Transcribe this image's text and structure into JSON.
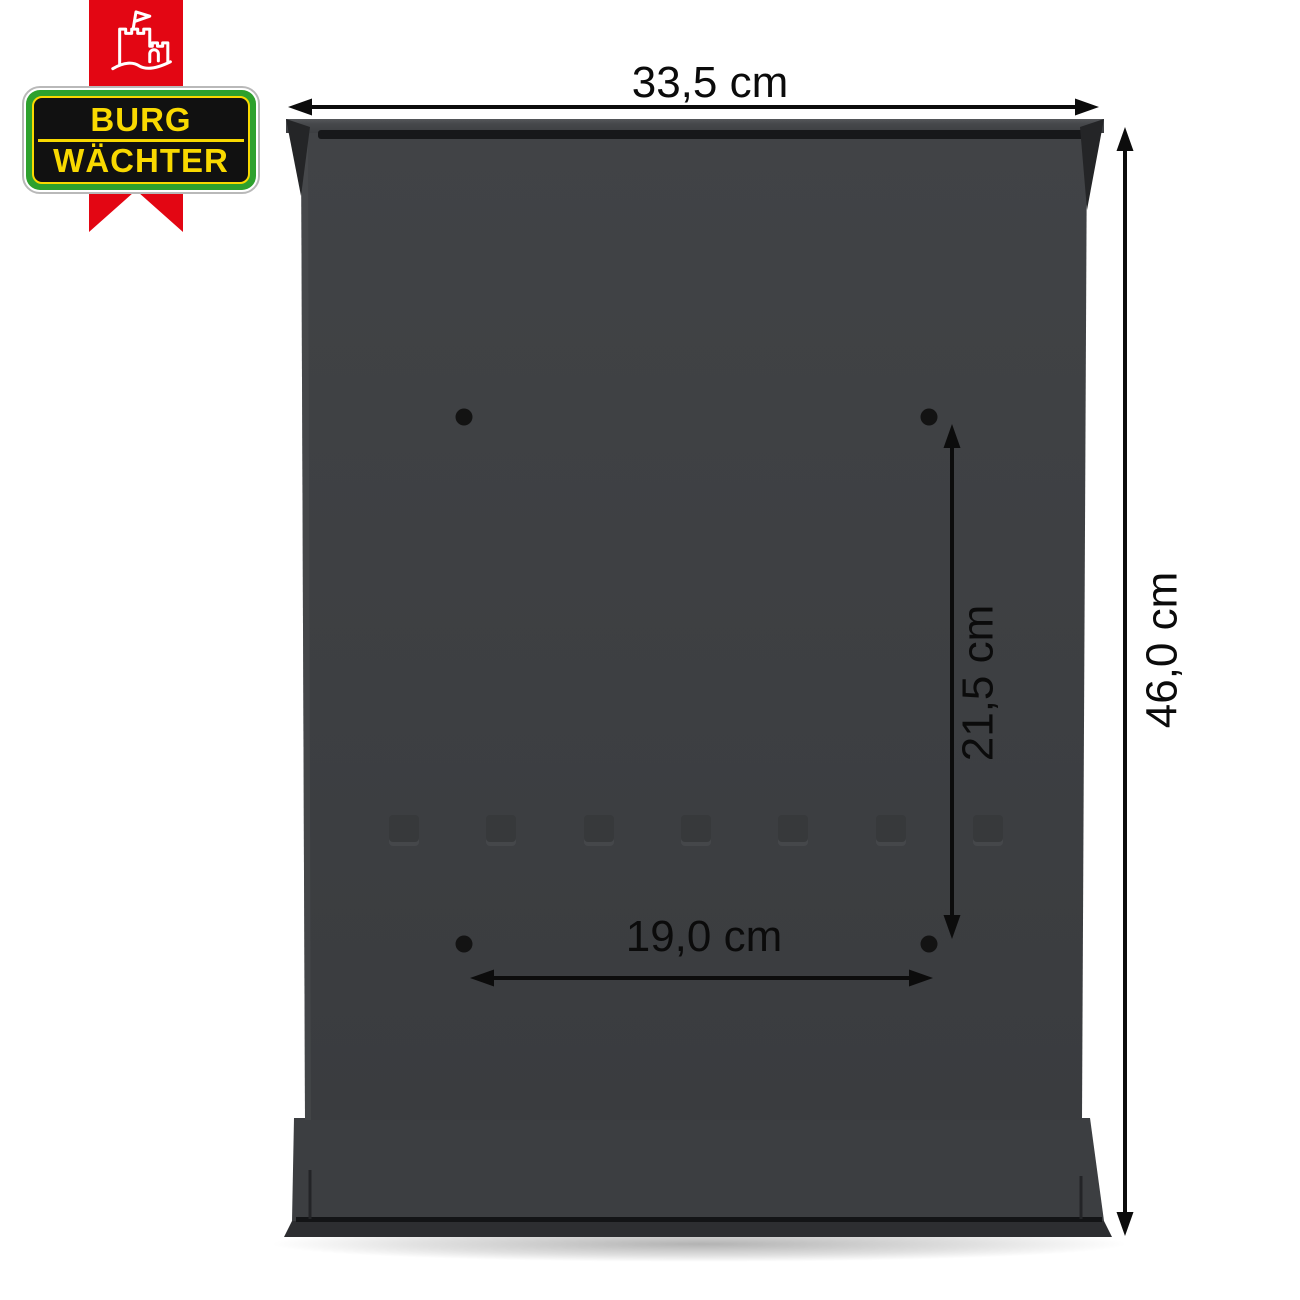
{
  "page": {
    "title": "Mailbox rear panel dimension diagram",
    "background_color": "#ffffff"
  },
  "logo": {
    "ribbon_color": "#e30613",
    "castle_icon": "castle-icon",
    "badge": {
      "line1": "BURG",
      "line2": "WÄCHTER",
      "text_color": "#f9d900",
      "green_color": "#2da12d",
      "field_color": "#111111"
    }
  },
  "product": {
    "name": "mailbox rear panel",
    "body_color": "#3e4043",
    "mounting_hole_count": 4,
    "embossed_slot_count": 7
  },
  "dimensions": {
    "line_color": "#0c0c0c",
    "overall_width": {
      "label": "33,5 cm",
      "orientation": "horizontal"
    },
    "overall_height": {
      "label": "46,0 cm",
      "orientation": "vertical"
    },
    "hole_spacing_vertical": {
      "label": "21,5 cm",
      "orientation": "vertical"
    },
    "hole_spacing_horizontal": {
      "label": "19,0 cm",
      "orientation": "horizontal"
    }
  }
}
